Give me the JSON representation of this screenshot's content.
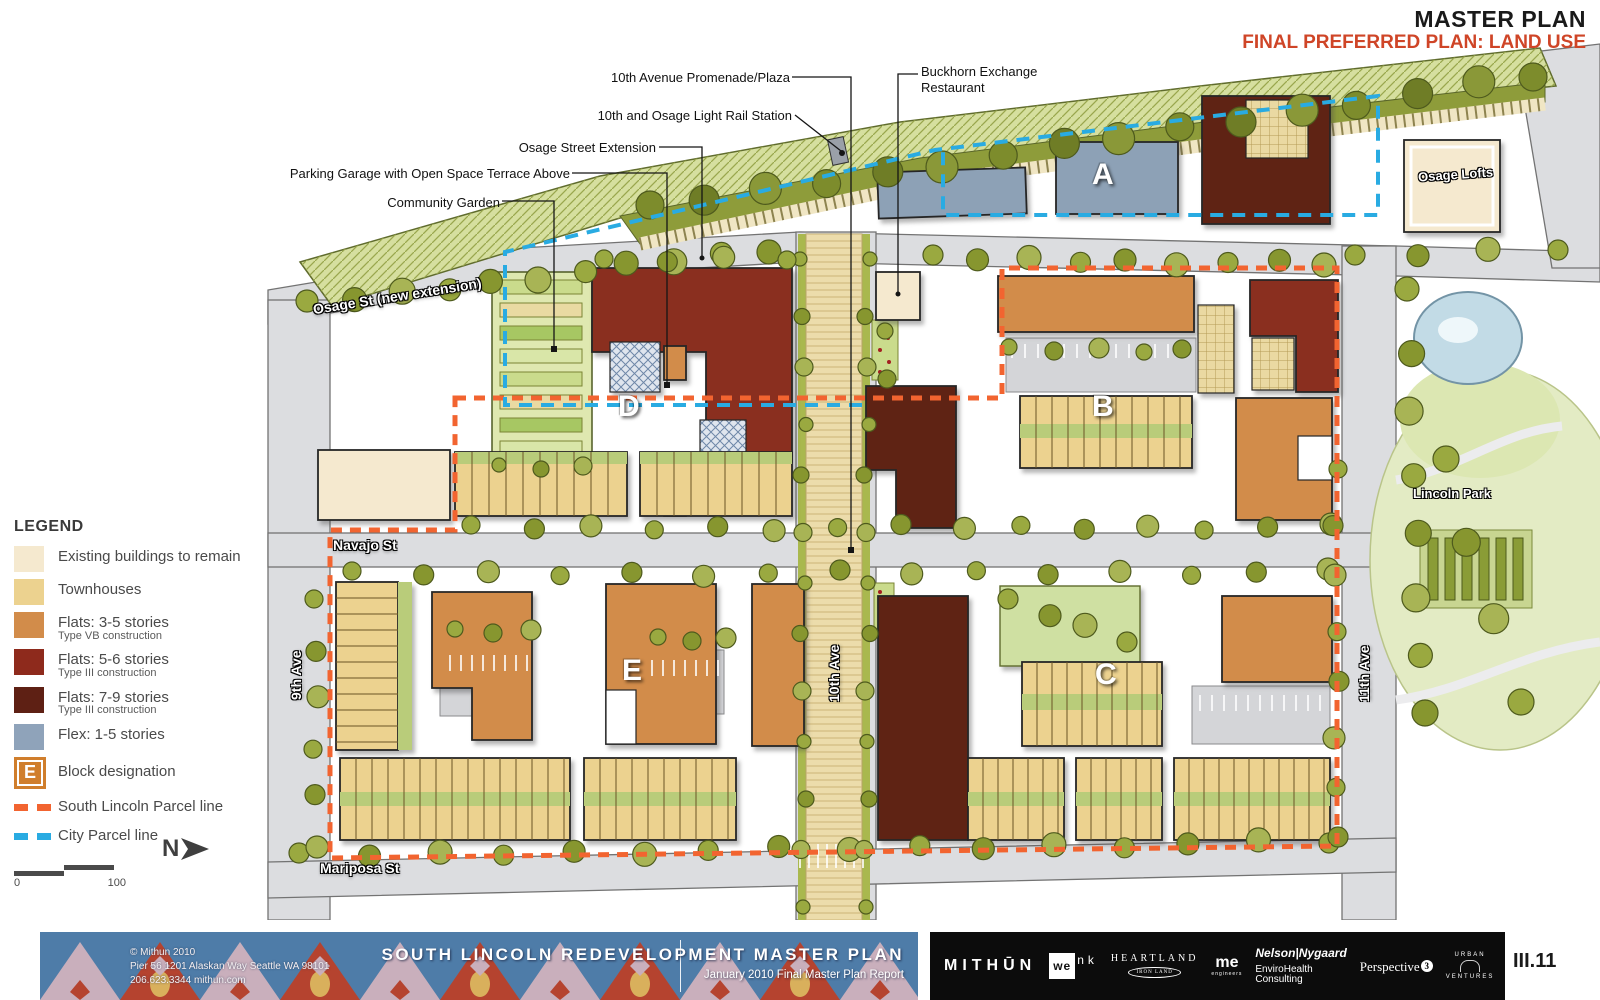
{
  "titles": {
    "main": "MASTER PLAN",
    "sub": "FINAL PREFERRED PLAN: LAND USE"
  },
  "annotations": {
    "promenade": "10th Avenue Promenade/Plaza",
    "buckhorn": "Buckhorn Exchange Restaurant",
    "station": "10th and Osage Light Rail Station",
    "osage_ext": "Osage Street Extension",
    "garage": "Parking Garage with Open Space Terrace Above",
    "garden": "Community Garden"
  },
  "map": {
    "streets": {
      "osage": "Osage St (new extension)",
      "navajo": "Navajo St",
      "mariposa": "Mariposa St",
      "ninth": "9th Ave",
      "tenth": "10th Ave",
      "eleventh": "11th Ave"
    },
    "blocks": {
      "a": "A",
      "b": "B",
      "c": "C",
      "d": "D",
      "e": "E"
    },
    "places": {
      "osage_lofts": "Osage Lofts",
      "lincoln_park": "Lincoln Park"
    }
  },
  "legend": {
    "title": "LEGEND",
    "items": [
      {
        "label": "Existing buildings to remain",
        "sub": "",
        "color": "#f5e9cf"
      },
      {
        "label": "Townhouses",
        "sub": "",
        "color": "#ecd28f"
      },
      {
        "label": "Flats: 3-5 stories",
        "sub": "Type VB construction",
        "color": "#d28c4a"
      },
      {
        "label": "Flats: 5-6 stories",
        "sub": "Type III construction",
        "color": "#8e2a1c"
      },
      {
        "label": "Flats: 7-9 stories",
        "sub": "Type III construction",
        "color": "#5e2014"
      },
      {
        "label": "Flex: 1-5 stories",
        "sub": "",
        "color": "#8fa3ba"
      }
    ],
    "block_designation": {
      "letter": "E",
      "label": "Block designation",
      "color": "#d07e2c"
    },
    "parcels": [
      {
        "label": "South Lincoln Parcel line",
        "color": "#f26430"
      },
      {
        "label": "City Parcel line",
        "color": "#29abe2"
      }
    ]
  },
  "scale": {
    "min": "0",
    "max": "100"
  },
  "north": {
    "letter": "N"
  },
  "footer": {
    "copyright": {
      "l1": "© Mithun 2010",
      "l2": "Pier 56  1201 Alaskan Way  Seattle WA  98101",
      "l3": "206.623.3344  mithun.com"
    },
    "plan_title": "SOUTH LINCOLN REDEVELOPMENT MASTER PLAN",
    "plan_subtitle": "January 2010 Final Master Plan Report",
    "logos": {
      "mithun": "MITHŪN",
      "wenk_box": "we",
      "wenk_rest": "nk",
      "heartland": "HEARTLAND",
      "heartland_sub": "IRON LAND",
      "me": "me",
      "me_sub": "engineers",
      "nelson": "Nelson|Nygaard",
      "enviro": "EnviroHealth Consulting",
      "perspective": "Perspective",
      "perspective_n": "3",
      "urban_top": "URBAN",
      "urban_bottom": "VENTURES",
      "dha": "DHA",
      "dha_sub": "DENVERHOUSINGAUTHORITY"
    },
    "page": "III.11"
  }
}
